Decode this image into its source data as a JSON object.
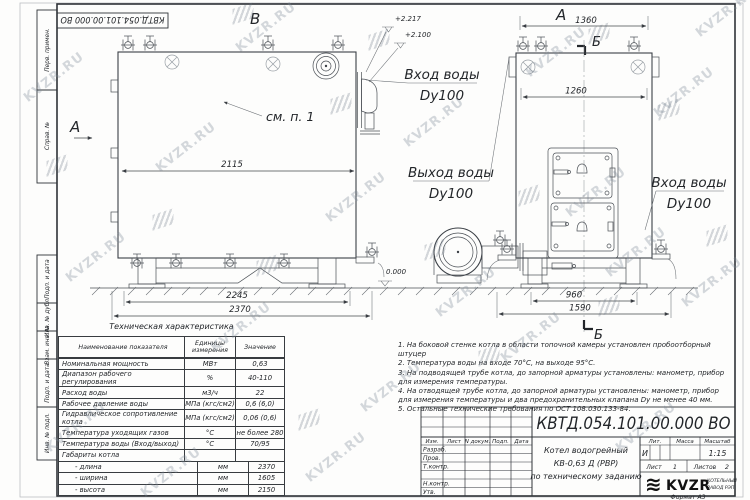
{
  "watermark": {
    "text": "KVZR.RU"
  },
  "stamp": {
    "code": "КВТД.054.101.00.000 ВО"
  },
  "sidebar": {
    "labels": [
      "Перв. примен.",
      "Справ. №",
      "Подп. и дата",
      "Инв. № дубл.",
      "Взам. инв. №",
      "Подп. и дата",
      "Инв. № подл."
    ]
  },
  "views": {
    "view_b_label": "В",
    "view_a_label": "А",
    "view_a_side_label": "А",
    "section_label_top": "Б",
    "section_label_bottom": "Б",
    "see_item": "см. п. 1",
    "water_inlet": "Вход воды",
    "water_outlet": "Выход воды",
    "dy": "Dy100",
    "elevations": {
      "top": "+2.217",
      "mid": "+2.100",
      "zero": "0.000"
    },
    "dims": {
      "left_inner": "2115",
      "left_base": "2245",
      "left_total": "2370",
      "right_top": "1360",
      "right_body": "1260",
      "right_base": "960",
      "right_total": "1590"
    }
  },
  "table": {
    "title": "Техническая характеристика",
    "headers": [
      "Наименование показателя",
      "Единицы измерения",
      "Значение"
    ],
    "rows": [
      {
        "name": "Номинальная мощность",
        "unit": "МВт",
        "value": "0,63"
      },
      {
        "name": "Диапазон рабочего регулирования",
        "unit": "%",
        "value": "40-110"
      },
      {
        "name": "Расход воды",
        "unit": "м3/ч",
        "value": "22"
      },
      {
        "name": "Рабочее давление воды",
        "unit": "МПа (кгс/см2)",
        "value": "0,6 (6,0)"
      },
      {
        "name": "Гидравлическое сопротивление котла",
        "unit": "МПа (кгс/см2)",
        "value": "0,06 (0,6)"
      },
      {
        "name": "Температура уходящих газов",
        "unit": "°С",
        "value": "не более 280"
      },
      {
        "name": "Температура воды (Вход/выход)",
        "unit": "°С",
        "value": "70/95"
      },
      {
        "name": "Габариты котла",
        "unit": "",
        "value": ""
      },
      {
        "name": "- длина",
        "unit": "мм",
        "value": "2370"
      },
      {
        "name": "- ширина",
        "unit": "мм",
        "value": "1605"
      },
      {
        "name": "- высота",
        "unit": "мм",
        "value": "2150"
      }
    ]
  },
  "notes": [
    "1.  На боковой стенке котла в области топочной камеры установлен пробоотборный штуцер",
    "2.  Температура воды на входе 70°С, на выходе 95°С.",
    "3.  На подводящей трубе котла, до запорной арматуры установлены: манометр, прибор для измерения температуры.",
    "4.  На отводящей трубе котла, до запорной арматуры установлены: манометр, прибор для измерения температуры и два предохранительных клапана Dу не менее 40 мм.",
    "5.  Остальные технические требования по ОСТ 108.030.133-84."
  ],
  "titleblock": {
    "doc_number": "КВТД.054.101.00.000 ВО",
    "product_line1": "Котел водогрейный",
    "product_line2": "КВ-0,63 Д (РВР)",
    "product_line3": "по техническому заданию",
    "columns": [
      "Изм.",
      "Лист",
      "N докум.",
      "Подп.",
      "Дата"
    ],
    "rows": [
      "Разраб.",
      "Пров.",
      "Т.контр.",
      "Н.контр.",
      "Утв."
    ],
    "lit_label": "Лит.",
    "lit_value": "И",
    "mass_label": "Масса",
    "scale_label": "Масштаб",
    "scale_value": "1:15",
    "sheet_label": "Лист",
    "sheet_value": "1",
    "sheets_label": "Листов",
    "sheets_value": "2",
    "logo": {
      "icon": "≋",
      "brand": "KVZR",
      "sub1": "КОТЕЛЬНЫЙ",
      "sub2": "ЗАВОД РЭП"
    },
    "format": "Формат  А3"
  }
}
